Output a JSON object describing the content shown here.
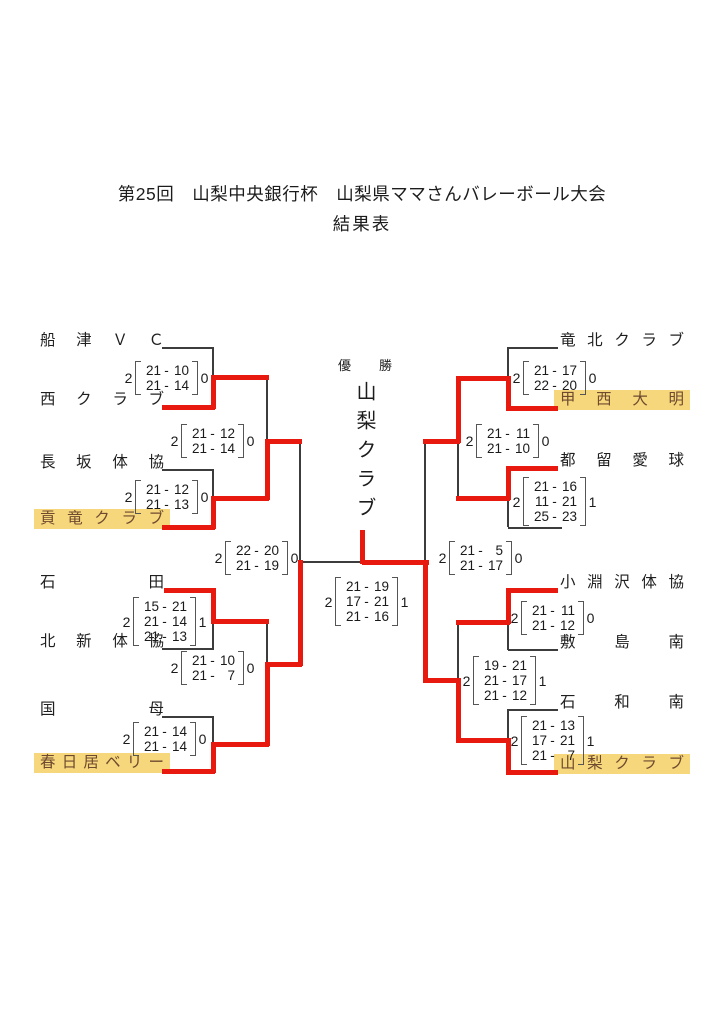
{
  "title": {
    "line1": "第25回　山梨中央銀行杯　山梨県ママさんバレーボール大会",
    "line2": "結果表"
  },
  "champion": {
    "label": "優勝",
    "name": "山梨クラブ"
  },
  "teams": {
    "l0": {
      "name": "船津ＶＣ"
    },
    "l1": {
      "name": "西クラブ"
    },
    "l2": {
      "name": "長坂体協"
    },
    "l3": {
      "name": "貢竜クラブ",
      "highlight": true
    },
    "l4": {
      "name": "石田"
    },
    "l5": {
      "name": "北新体協"
    },
    "l6": {
      "name": "国母"
    },
    "l7": {
      "name": "春日居ベリー",
      "highlight": true
    },
    "r0": {
      "name": "竜北クラブ"
    },
    "r1": {
      "name": "甲西大明",
      "highlight": true
    },
    "r2": {
      "name": "都留愛球"
    },
    "r3": {
      "name": ""
    },
    "r4": {
      "name": "小淵沢体協"
    },
    "r5": {
      "name": "敷島南"
    },
    "r6": {
      "name": "石和南"
    },
    "r7": {
      "name": "山梨クラブ",
      "highlight": true
    }
  },
  "scores": {
    "m1L": {
      "w": 2,
      "l": 0,
      "sets": [
        [
          21,
          10
        ],
        [
          21,
          14
        ]
      ],
      "winner": "西クラブ"
    },
    "r2uL": {
      "w": 2,
      "l": 0,
      "sets": [
        [
          21,
          12
        ],
        [
          21,
          14
        ]
      ],
      "winner": "貢竜クラブ"
    },
    "m2L": {
      "w": 2,
      "l": 0,
      "sets": [
        [
          21,
          12
        ],
        [
          21,
          13
        ]
      ],
      "winner": "貢竜クラブ"
    },
    "sfL": {
      "w": 2,
      "l": 0,
      "sets": [
        [
          22,
          20
        ],
        [
          21,
          19
        ]
      ],
      "winner": "春日居ベリー"
    },
    "m3L": {
      "w": 2,
      "l": 1,
      "sets": [
        [
          15,
          21
        ],
        [
          21,
          14
        ],
        [
          21,
          13
        ]
      ],
      "winner": "石田"
    },
    "r2lL": {
      "w": 2,
      "l": 0,
      "sets": [
        [
          21,
          10
        ],
        [
          21,
          7
        ]
      ],
      "winner": "春日居ベリー"
    },
    "m4L": {
      "w": 2,
      "l": 0,
      "sets": [
        [
          21,
          14
        ],
        [
          21,
          14
        ]
      ],
      "winner": "春日居ベリー"
    },
    "fin": {
      "w": 2,
      "l": 1,
      "sets": [
        [
          21,
          19
        ],
        [
          17,
          21
        ],
        [
          21,
          16
        ]
      ],
      "winner": "山梨クラブ"
    },
    "m1R": {
      "w": 2,
      "l": 0,
      "sets": [
        [
          21,
          17
        ],
        [
          22,
          20
        ]
      ],
      "winner": "甲西大明"
    },
    "r2uR": {
      "w": 2,
      "l": 0,
      "sets": [
        [
          21,
          11
        ],
        [
          21,
          10
        ]
      ],
      "winner": "甲西大明"
    },
    "m2R": {
      "w": 2,
      "l": 1,
      "sets": [
        [
          21,
          16
        ],
        [
          11,
          21
        ],
        [
          25,
          23
        ]
      ],
      "winner": "都留愛球"
    },
    "sfR": {
      "w": 2,
      "l": 0,
      "sets": [
        [
          21,
          5
        ],
        [
          21,
          17
        ]
      ],
      "winner": "山梨クラブ"
    },
    "m3R": {
      "w": 2,
      "l": 0,
      "sets": [
        [
          21,
          11
        ],
        [
          21,
          12
        ]
      ],
      "winner": "小淵沢体協"
    },
    "r2lR": {
      "w": 2,
      "l": 1,
      "sets": [
        [
          19,
          21
        ],
        [
          21,
          17
        ],
        [
          21,
          12
        ]
      ],
      "winner": "山梨クラブ"
    },
    "m4R": {
      "w": 2,
      "l": 1,
      "sets": [
        [
          21,
          13
        ],
        [
          17,
          21
        ],
        [
          21,
          7
        ]
      ],
      "winner": "山梨クラブ"
    }
  },
  "colors": {
    "winner_path": "#e8190f",
    "line": "#3c3c3c",
    "highlight_bg": "#f6d77b"
  }
}
